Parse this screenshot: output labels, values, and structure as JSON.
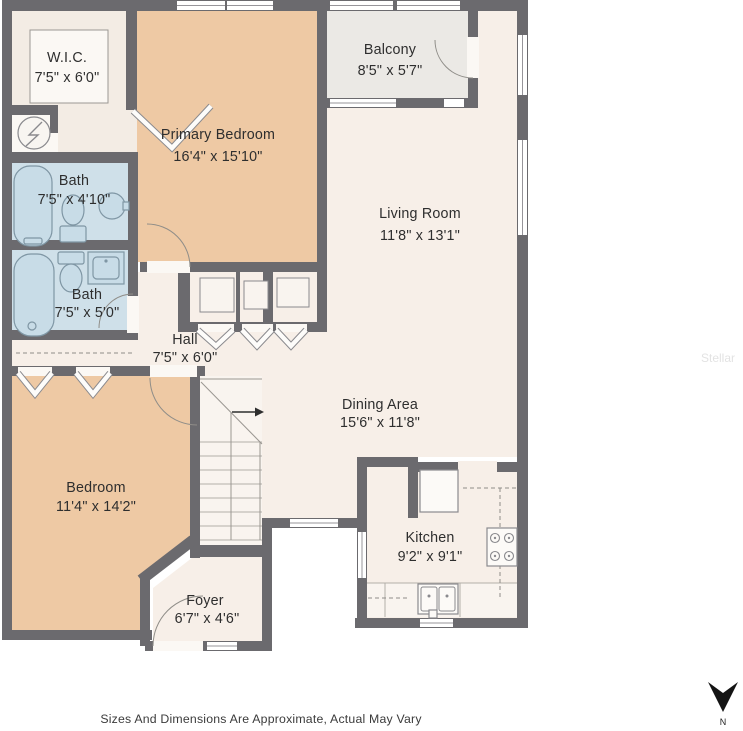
{
  "floor_plan": {
    "rooms": {
      "wic": {
        "name": "W.I.C.",
        "dims": "7'5\" x 6'0\""
      },
      "primary_bedroom": {
        "name": "Primary Bedroom",
        "dims": "16'4\" x 15'10\""
      },
      "balcony": {
        "name": "Balcony",
        "dims": "8'5\" x 5'7\""
      },
      "living_room": {
        "name": "Living Room",
        "dims": "11'8\" x 13'1\""
      },
      "bath_upper": {
        "name": "Bath",
        "dims": "7'5\" x 4'10\""
      },
      "bath_lower": {
        "name": "Bath",
        "dims": "7'5\" x 5'0\""
      },
      "hall": {
        "name": "Hall",
        "dims": "7'5\" x 6'0\""
      },
      "bedroom": {
        "name": "Bedroom",
        "dims": "11'4\" x 14'2\""
      },
      "dining": {
        "name": "Dining Area",
        "dims": "15'6\" x 11'8\""
      },
      "kitchen": {
        "name": "Kitchen",
        "dims": "9'2\" x 9'1\""
      },
      "foyer": {
        "name": "Foyer",
        "dims": "6'7\" x 4'6\""
      }
    },
    "disclaimer": "Sizes And Dimensions Are Approximate, Actual May Vary",
    "compass_label": "N",
    "watermark": "Stellar",
    "colors": {
      "wall": "#6b6a6e",
      "bedroom_fill": "#eec9a4",
      "common_fill": "#f7efe8",
      "bath_fill": "#cfe0e9",
      "balcony_fill": "#ebe9e5",
      "text": "#2e2e2e"
    }
  }
}
